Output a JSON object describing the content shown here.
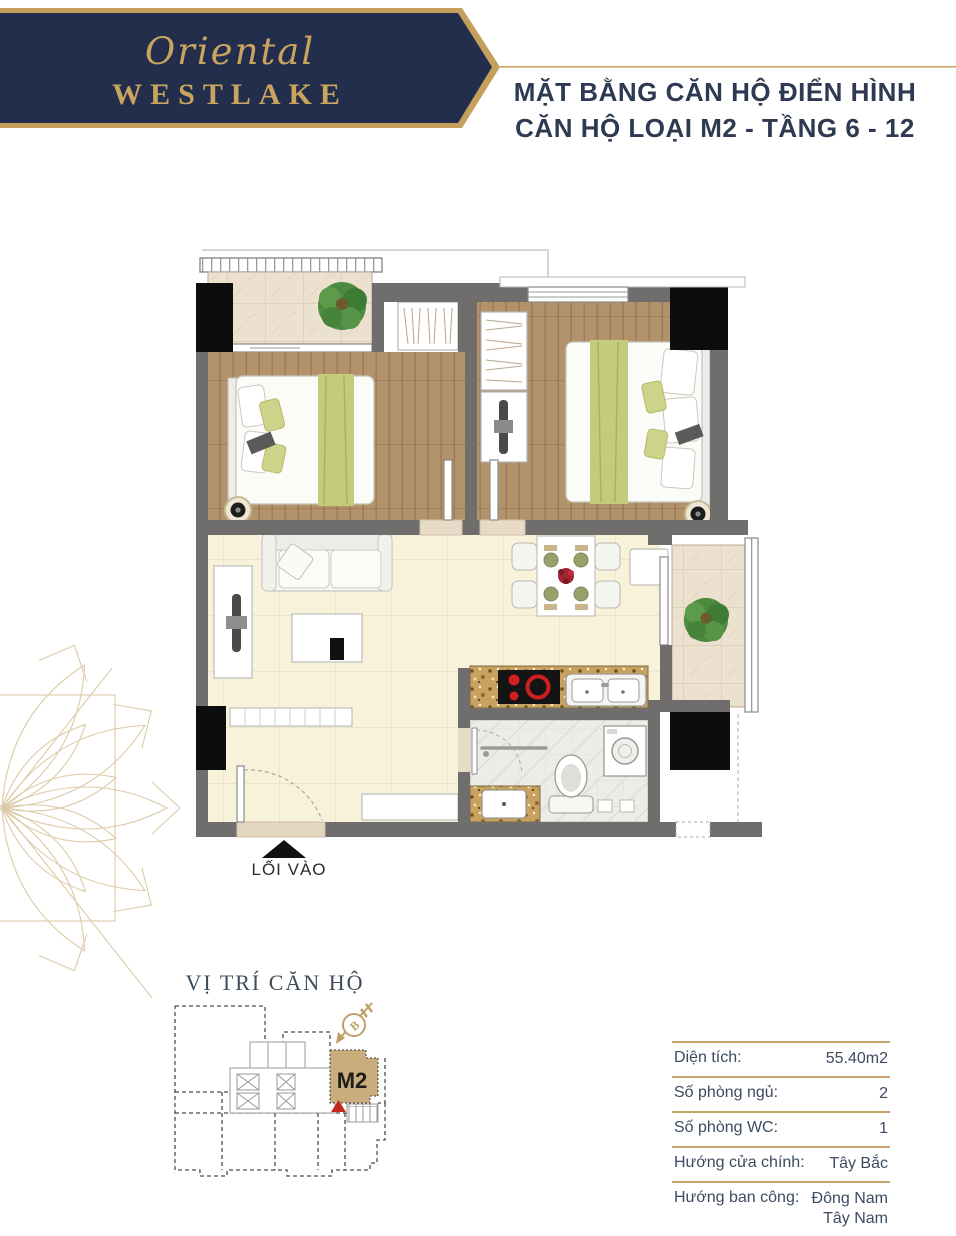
{
  "brand": {
    "name_script": "Oriental",
    "name_caps": "WESTLAKE"
  },
  "header": {
    "title_line1": "MẶT BẰNG CĂN HỘ ĐIỂN HÌNH",
    "title_line2": "CĂN HỘ LOẠI M2 - TẦNG 6 - 12"
  },
  "floorplan": {
    "entrance_label": "LỐI VÀO"
  },
  "keyplan": {
    "title": "VỊ TRÍ CĂN HỘ",
    "unit_label": "M2",
    "compass_letter": "B"
  },
  "spec_table": {
    "rows": [
      {
        "label": "Diện tích:",
        "value": "55.40m2"
      },
      {
        "label": "Số phòng ngủ:",
        "value": "2"
      },
      {
        "label": "Số phòng WC:",
        "value": "1"
      },
      {
        "label": "Hướng cửa chính:",
        "value": "Tây Bắc"
      },
      {
        "label": "Hướng ban công:",
        "value": "Đông Nam",
        "value2": "Tây Nam"
      }
    ]
  },
  "colors": {
    "navy": "#232e4c",
    "gold": "#c5a05c",
    "wall_grey": "#6f6e6c",
    "wood": "#b3936c",
    "cream_floor": "#f8f2da",
    "granite": "#c9a25f",
    "green_accent": "#c5cb7c",
    "unit_highlight": "#c9ad7c",
    "marker_red": "#c4291d"
  },
  "icons": {
    "compass": "compass-north-arrow",
    "entrance_arrow": "up-triangle"
  }
}
